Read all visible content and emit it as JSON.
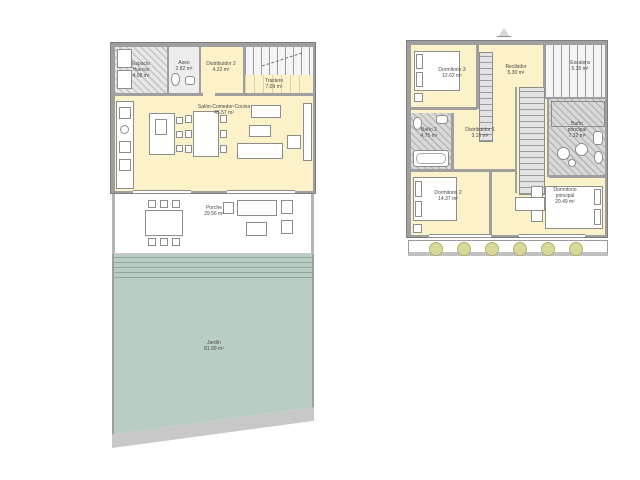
{
  "document_type": "floor-plan",
  "units_suffix": "m²",
  "ground_floor": {
    "rooms": [
      {
        "name": "Espacio",
        "name2": "Huecos",
        "area": "4.08 m²"
      },
      {
        "name": "Aseo",
        "area": "2.82 m²"
      },
      {
        "name": "Distribuidor 2",
        "area": "4.22 m²"
      },
      {
        "name": "Trastero",
        "area": "7.09 m²"
      },
      {
        "name": "Salón-Comedor-Cocina",
        "area": "45.57 m²"
      },
      {
        "name": "Porche",
        "area": "29.56 m²"
      },
      {
        "name": "Jardín",
        "area": "81.99 m²"
      }
    ]
  },
  "upper_floor": {
    "rooms": [
      {
        "name": "Dormitorio 3",
        "area": "12.62 m²"
      },
      {
        "name": "Recibidor",
        "area": "5.30 m²"
      },
      {
        "name": "Escalera",
        "area": "5.35 m²"
      },
      {
        "name": "Baño 2",
        "area": "4.75 m²"
      },
      {
        "name": "Distribuidor 1",
        "area": "3.15 m²"
      },
      {
        "name": "Baño",
        "name2": "principal",
        "area": "7.32 m²"
      },
      {
        "name": "Dormitorio 2",
        "area": "14.37 m²"
      },
      {
        "name": "Dormitorio",
        "name2": "principal",
        "area": "20.49 m²"
      }
    ]
  },
  "colors": {
    "paper": "#ffffff",
    "wall": "#9f9f9f",
    "room_fill": "#fbf2ca",
    "garden": "#b9cec2",
    "planter": "#d9d89b",
    "bath_floor": "#d9d9d9"
  }
}
